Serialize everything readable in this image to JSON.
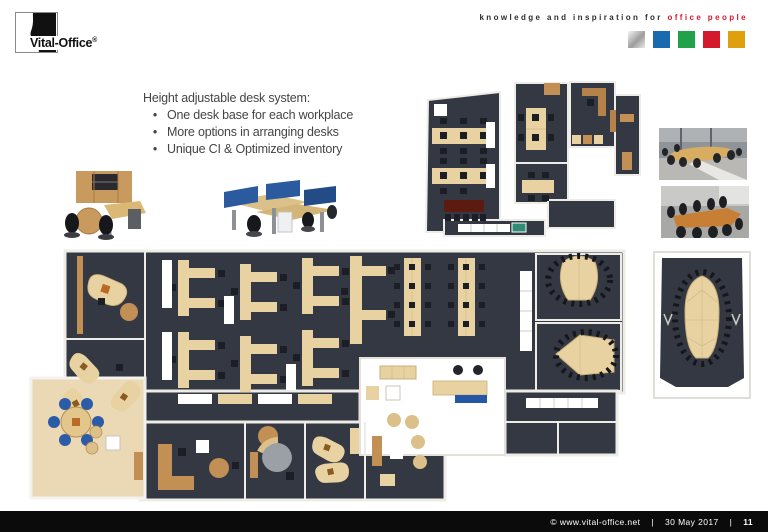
{
  "colors": {
    "floor": "#343842",
    "chair": "#1b1e24",
    "desk": "#e8d2a2",
    "wood": "#c28f54",
    "wall": "#edece6",
    "beige-floor": "#ead9b4",
    "accent-blue": "#2457a5",
    "page-blue": "#1a6ab0",
    "page-green": "#1fa24a",
    "page-red": "#d5192c",
    "page-amber": "#dfa00e",
    "footer-bg": "#0b0b0b",
    "text": "#454545",
    "table-red": "#5c1a10",
    "teal": "#2f8c77",
    "gray-desk": "#9aa0a6",
    "blue-chair": "#2c5ca8",
    "photo-wood": "#c77f35"
  },
  "header": {
    "logo_text": "Vital-Office",
    "logo_reg": "®",
    "tagline_plain": "knowledge and inspiration for ",
    "tagline_accent": "office people",
    "squares": [
      "silver",
      "blue",
      "green",
      "red",
      "amber"
    ]
  },
  "content": {
    "heading": "Height adjustable desk system:",
    "bullet_char": "•",
    "bullets": [
      "One desk base for each workplace",
      "More options in arranging desks",
      "Unique CI & Optimized inventory"
    ]
  },
  "figures": {
    "render_left": "executive-desk-render",
    "render_right": "bench-desks-with-blue-screens-render",
    "plan_top": "office-floorplan-upper",
    "plan_main": "office-floorplan-main",
    "plan_conference": "conference-room-floorplan",
    "photo_top": "conference-room-photo-oval-table",
    "photo_bottom": "conference-room-photo-long-table"
  },
  "footer": {
    "copyright": "©  www.vital-office.net",
    "sep1": "|",
    "date": "30 May 2017",
    "sep2": "|",
    "page": "11"
  }
}
